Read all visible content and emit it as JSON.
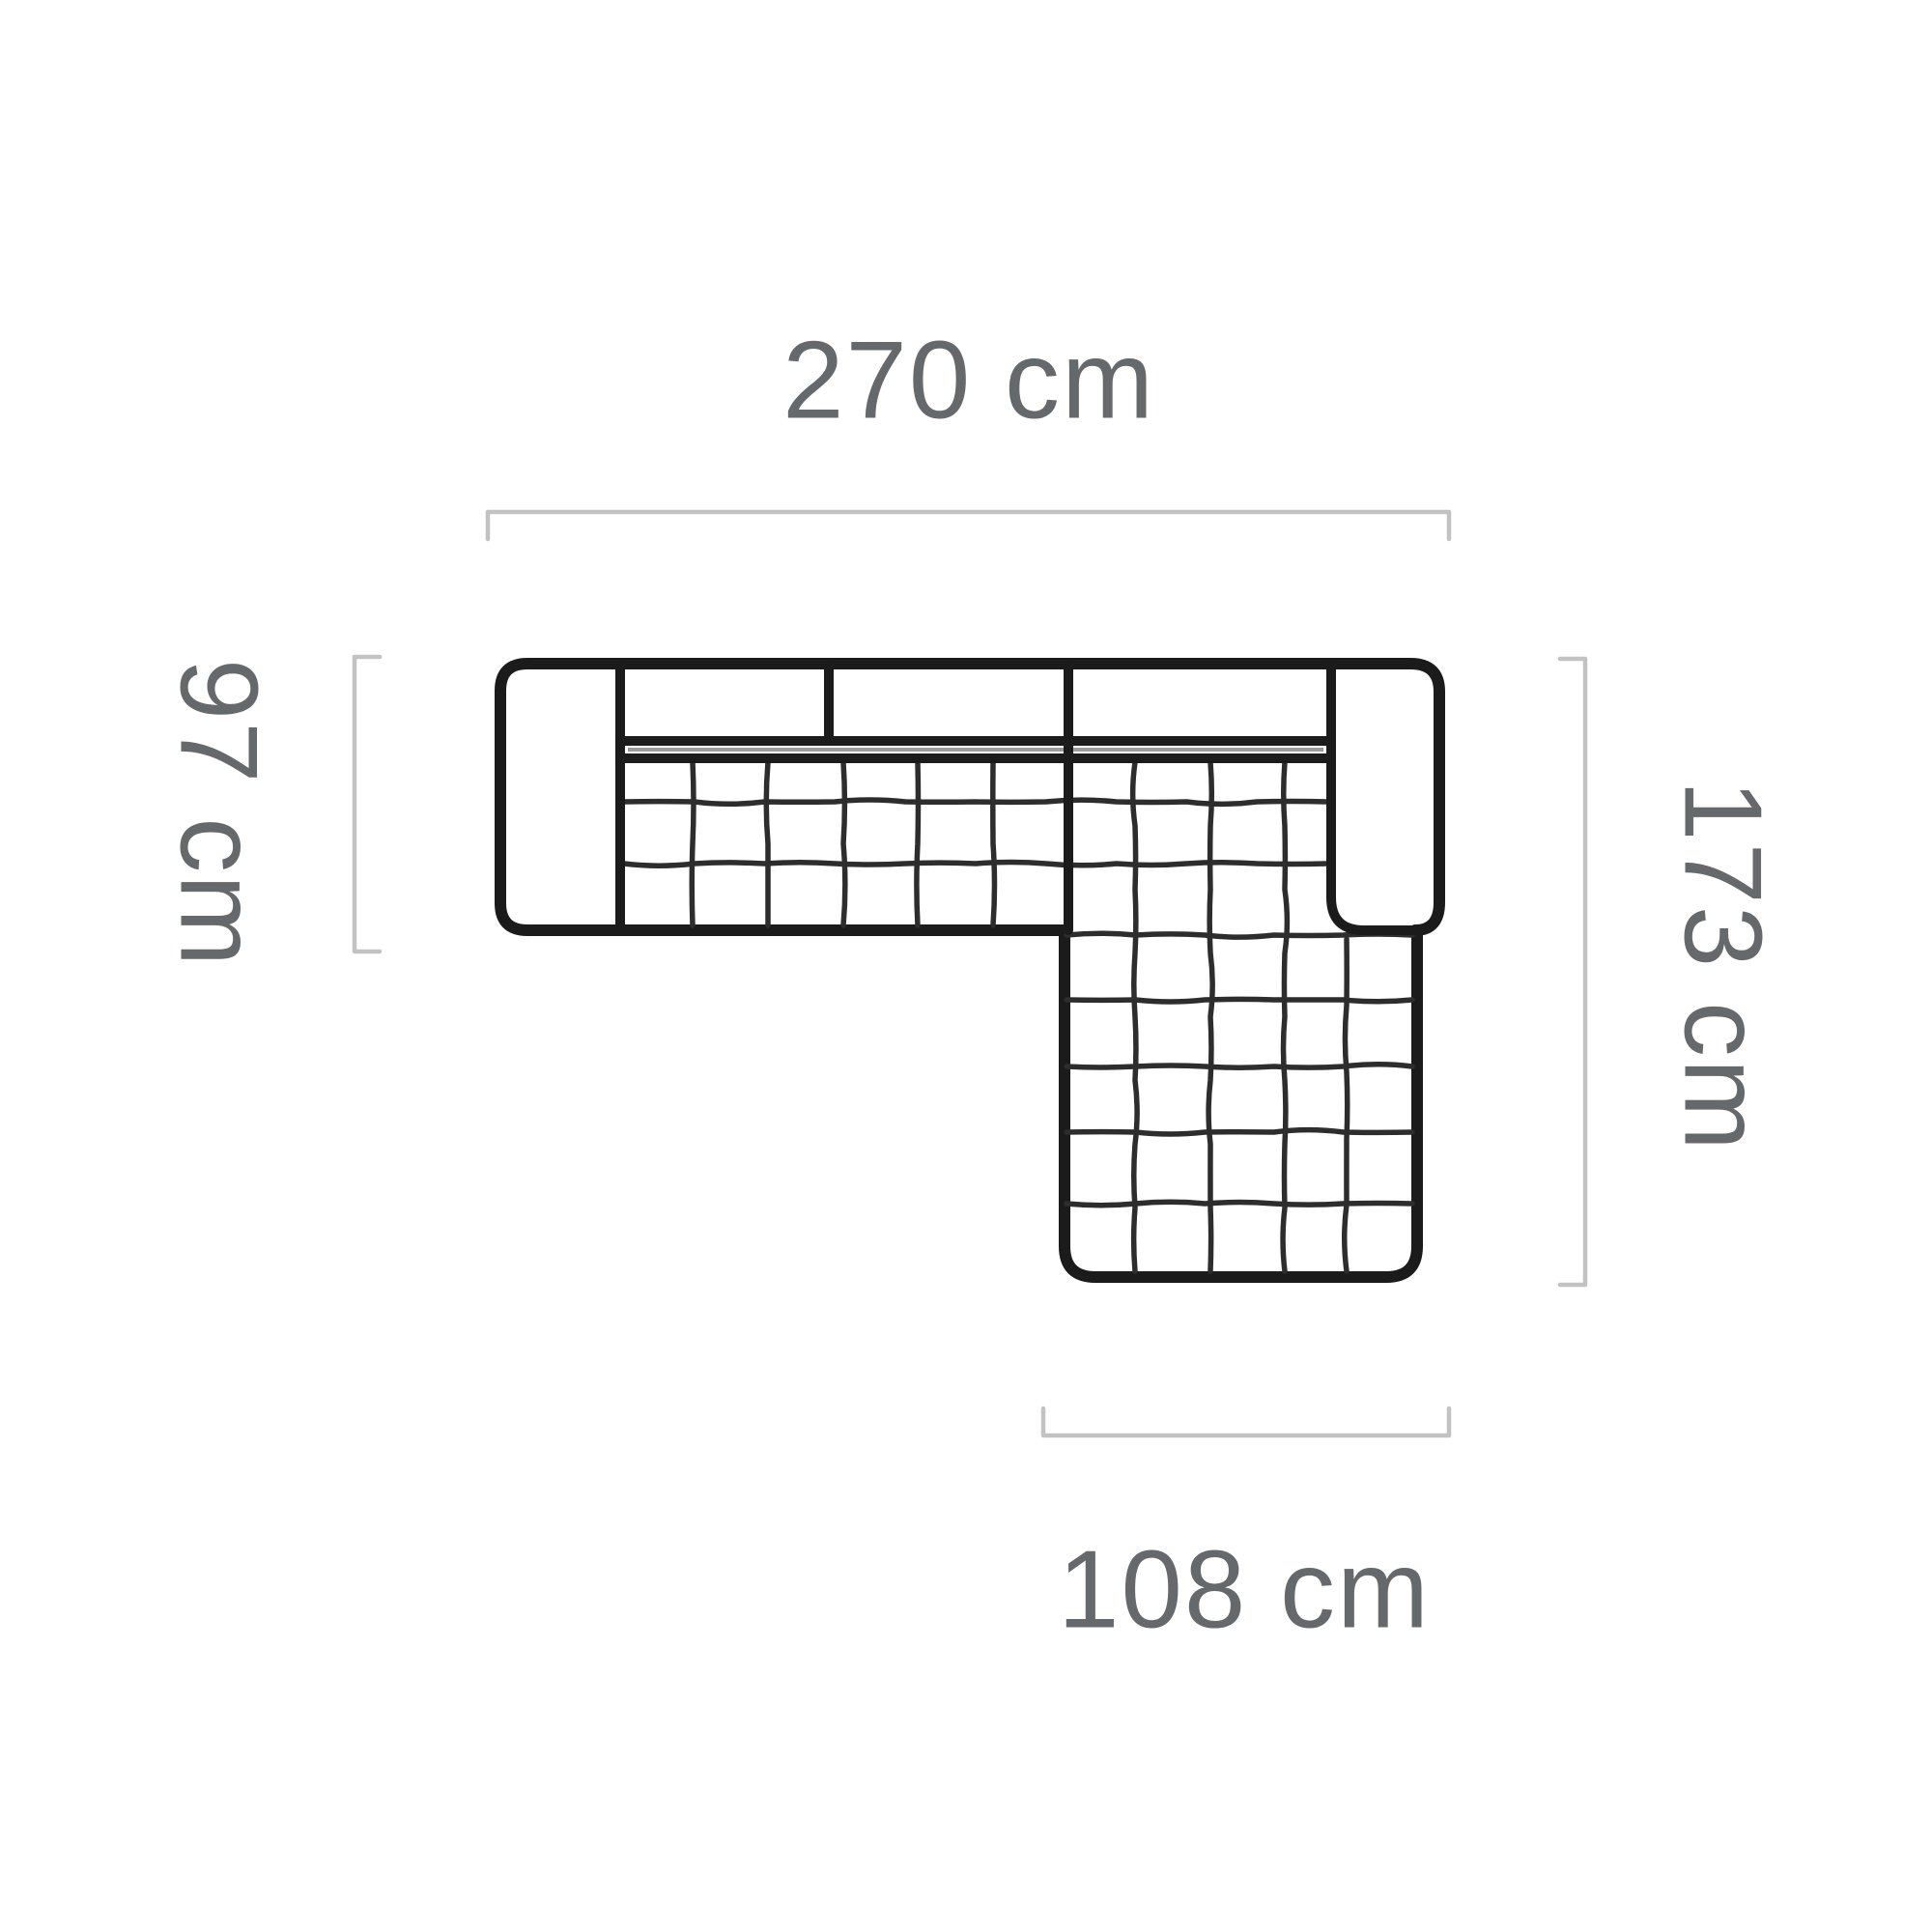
{
  "diagram": {
    "dimensions": {
      "top_width": {
        "label": "270 cm",
        "value": 270,
        "unit": "cm"
      },
      "left_depth": {
        "label": "97 cm",
        "value": 97,
        "unit": "cm"
      },
      "right_length": {
        "label": "173 cm",
        "value": 173,
        "unit": "cm"
      },
      "chaise_width": {
        "label": "108 cm",
        "value": 108,
        "unit": "cm"
      }
    },
    "colors": {
      "background": "#ffffff",
      "outline": "#1b1b1b",
      "quilt": "#2d2d2d",
      "seam": "#9b9b9b",
      "dimension_line": "#c2c2c2",
      "label_text": "#65696c"
    }
  }
}
